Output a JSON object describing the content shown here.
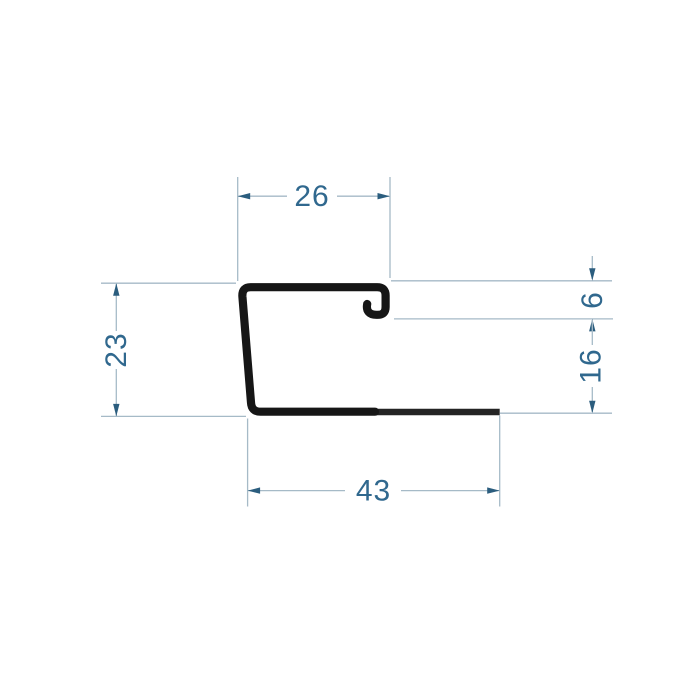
{
  "canvas": {
    "background": "#ffffff"
  },
  "drawing": {
    "kind": "profile-cross-section-technical-drawing",
    "colors": {
      "canvas_background": "#ffffff",
      "profile_color": "#161616",
      "dim_line_color": "#a6bac7",
      "dim_arrow_color": "#2b5d7e",
      "dim_text_color": "#30688e"
    },
    "dimensions": {
      "top_width": {
        "label": "26"
      },
      "right_upper_height": {
        "label": "6"
      },
      "right_lower_height": {
        "label": "16"
      },
      "left_height": {
        "label": "23"
      },
      "bottom_width": {
        "label": "43"
      }
    }
  }
}
